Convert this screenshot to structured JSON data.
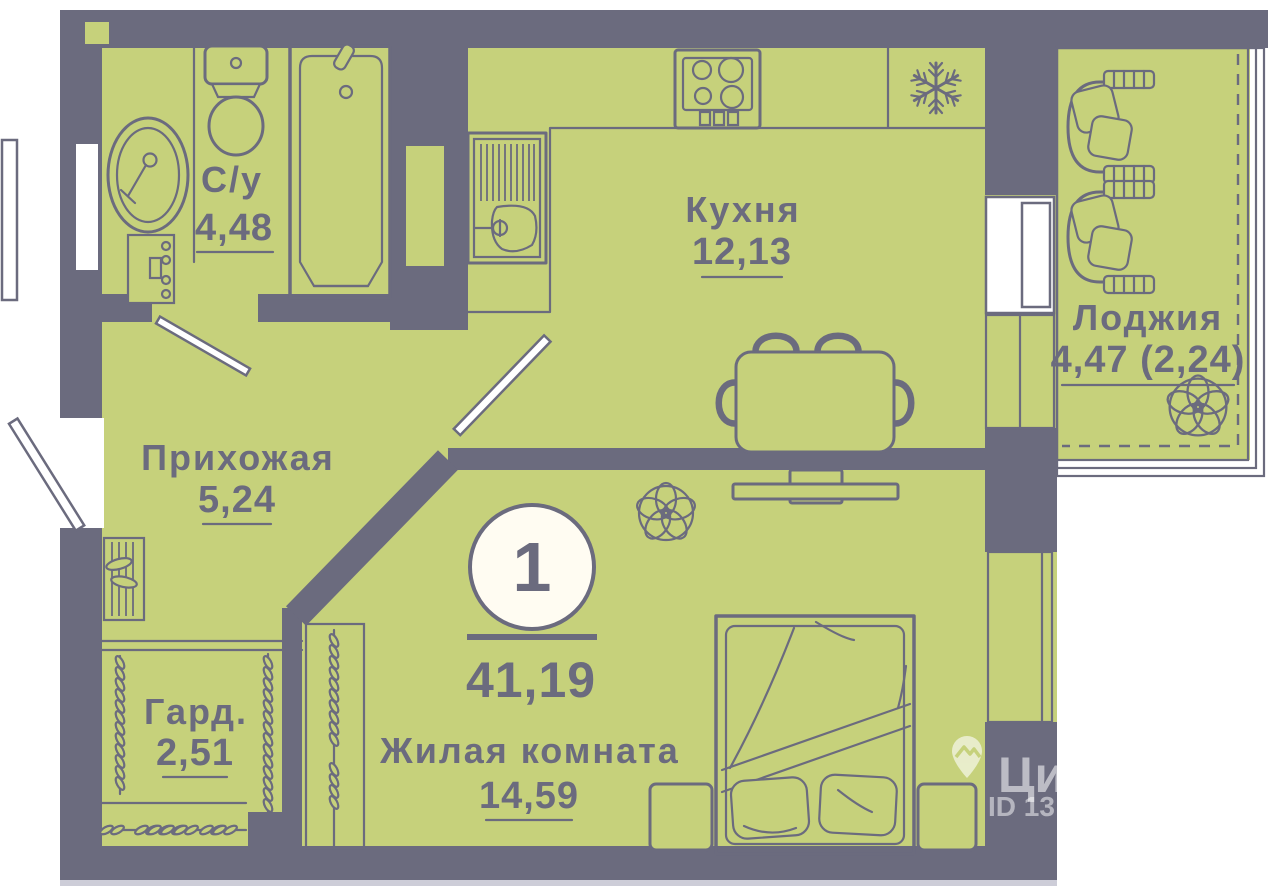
{
  "plan": {
    "rooms": {
      "bathroom": {
        "name": "С/у",
        "area": "4,48"
      },
      "kitchen": {
        "name": "Кухня",
        "area": "12,13"
      },
      "loggia": {
        "name": "Лоджия",
        "area": "4,47 (2,24)"
      },
      "hallway": {
        "name": "Прихожая",
        "area": "5,24"
      },
      "wardrobe": {
        "name": "Гард.",
        "area": "2,51"
      },
      "living_room": {
        "name": "Жилая комната",
        "area": "14,59"
      }
    },
    "badge": {
      "room_count": "1",
      "total_area": "41,19"
    },
    "watermark": {
      "brand": "Циан",
      "listing_id": "ID 13"
    },
    "colors": {
      "wall": "#6b6b7e",
      "floor": "#c6d17b",
      "line": "#6b6b7e",
      "background": "#ffffff",
      "badge_fill": "#fffcf2",
      "watermark": "#ffffff"
    }
  }
}
